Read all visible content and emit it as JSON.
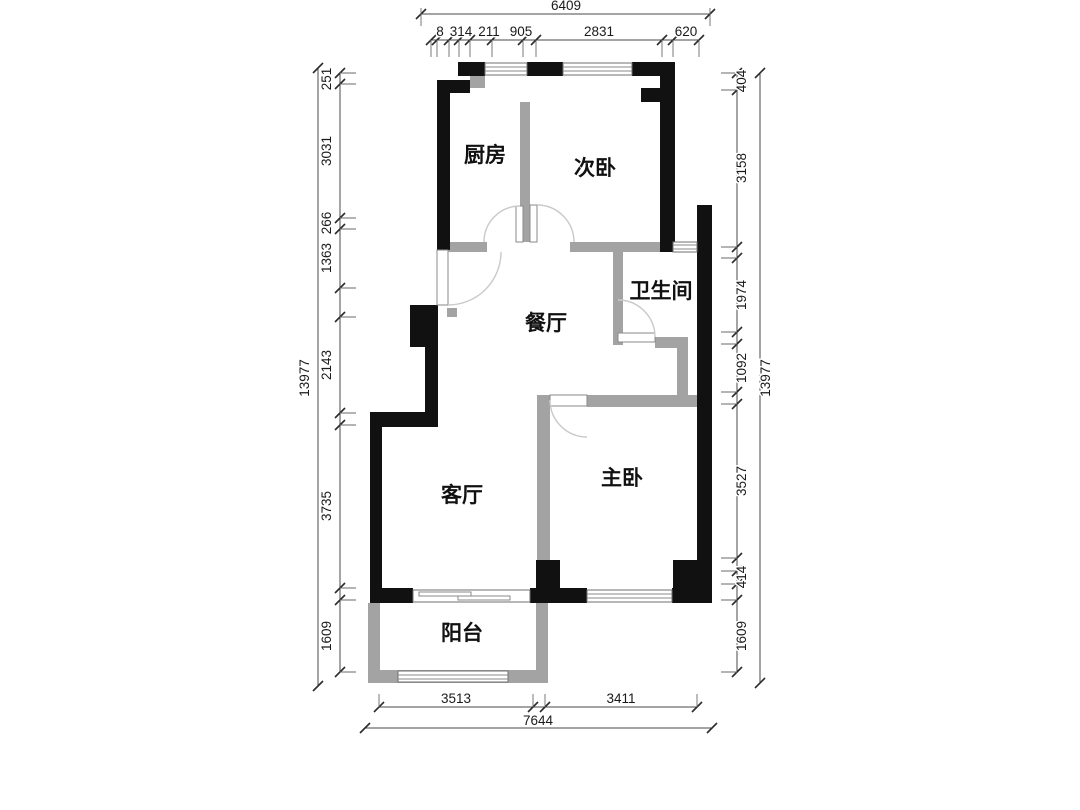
{
  "title": "两室一厅户型图",
  "rooms": {
    "kitchen": "厨房",
    "second_bedroom": "次卧",
    "bathroom": "卫生间",
    "dining": "餐厅",
    "living": "客厅",
    "master": "主卧",
    "balcony": "阳台"
  },
  "dims": {
    "top_overall": "6409",
    "top_segs": [
      "8",
      "314",
      "211",
      "905",
      "2831",
      "620"
    ],
    "left_overall": "13977",
    "left_segs": [
      "251",
      "3031",
      "266",
      "1363",
      "2143",
      "3735",
      "1609"
    ],
    "right_overall": "13977",
    "right_segs": [
      "404",
      "3158",
      "1974",
      "1092",
      "3527",
      "414",
      "1609"
    ],
    "bottom_overall": "7644",
    "bottom_segs": [
      "3513",
      "3411"
    ]
  },
  "colors": {
    "wall": "#111111",
    "partition": "#a3a3a3",
    "dim_line": "#4a4a4a",
    "arc": "#c9c9c9",
    "background": "#ffffff"
  }
}
